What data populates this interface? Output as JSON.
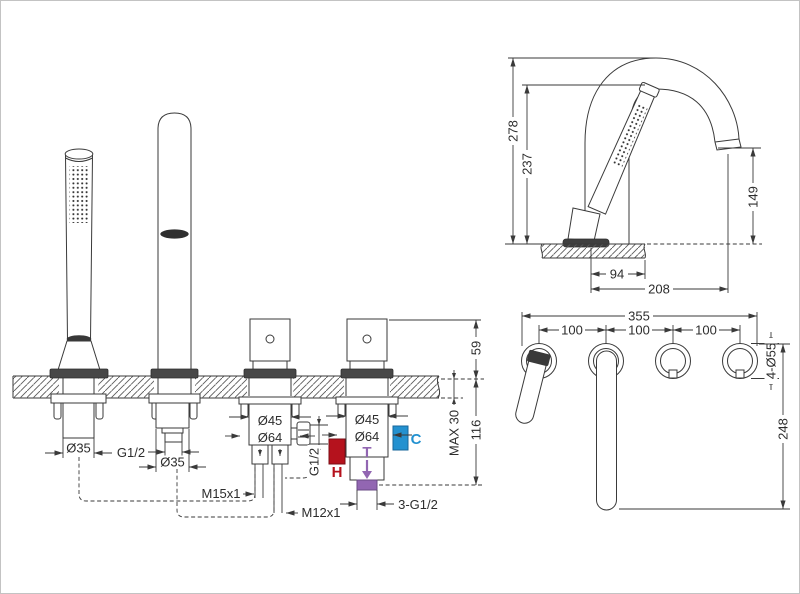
{
  "drawing_title": "Bathtub mixer installation dimensions",
  "front_view": {
    "labels": {
      "shower_dia": "Ø35",
      "spout_thread": "G1/2",
      "spout_dia": "Ø35",
      "diverter_dia": "Ø45",
      "diverter_base_dia": "Ø64",
      "mixer_dia": "Ø45",
      "mixer_base_dia": "Ø64",
      "shower_hose_thread": "M15x1",
      "spout_hose_thread": "M12x1",
      "side_port_thread": "G1/2",
      "bottom_threads": "3-G1/2",
      "handle_height": "59",
      "deck_thickness_max": "MAX 30",
      "under_deck_depth": "116",
      "hot": "H",
      "cold": "C",
      "mixed": "T"
    }
  },
  "side_view": {
    "labels": {
      "total_height": "278",
      "handshower_height": "237",
      "spout_outlet_height": "149",
      "handshower_offset": "94",
      "spout_reach": "208"
    }
  },
  "top_view": {
    "labels": {
      "overall_width": "355",
      "hole_spacing_1": "100",
      "hole_spacing_2": "100",
      "hole_spacing_3": "100",
      "hole_diameters": "4-Ø55",
      "overall_depth": "248"
    }
  },
  "colors": {
    "hot": "#b5121d",
    "cold": "#2391d0",
    "mixed": "#9266b2",
    "line": "#3a3a3a"
  }
}
